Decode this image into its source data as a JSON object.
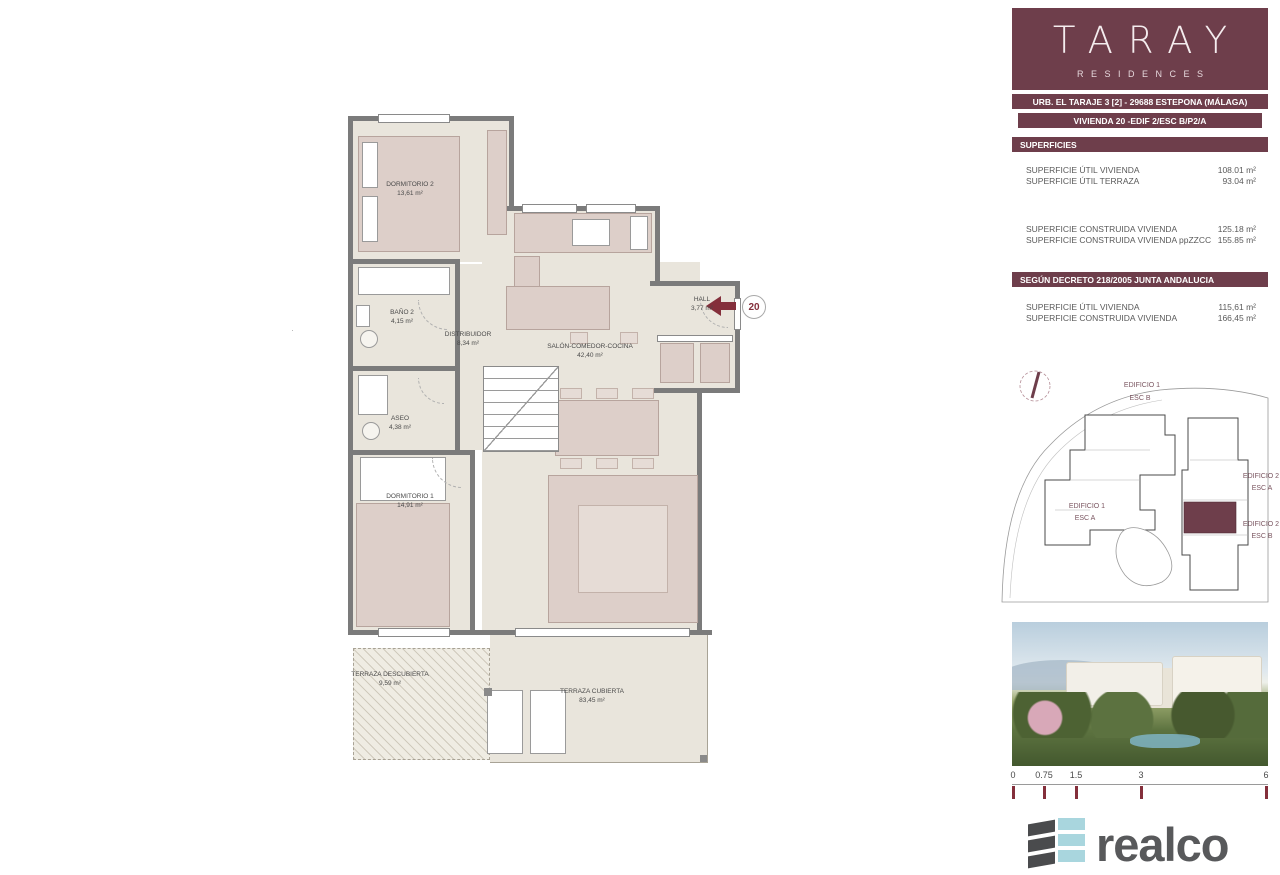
{
  "colors": {
    "brand_maroon": "#6e3e4b",
    "accent_wine": "#842f3b",
    "realco_gray": "#58595b",
    "realco_blue": "#a9d6de"
  },
  "brand": {
    "name": "TARAY",
    "sub": "RESIDENCES"
  },
  "header": {
    "address": "URB. EL TARAJE 3 [2] - 29688 ESTEPONA (MÁLAGA)",
    "unit": "VIVIENDA 20 -EDIF 2/ESC B/P2/A"
  },
  "superficies": {
    "title": "SUPERFICIES",
    "rows_util": [
      {
        "label": "SUPERFICIE ÚTIL VIVIENDA",
        "value": "108.01 m²"
      },
      {
        "label": "SUPERFICIE ÚTIL TERRAZA",
        "value": "93.04 m²"
      }
    ],
    "rows_construida": [
      {
        "label": "SUPERFICIE CONSTRUIDA VIVIENDA",
        "value": "125.18 m²"
      },
      {
        "label": "SUPERFICIE CONSTRUIDA VIVIENDA ppZZCC",
        "value": "155.85 m²"
      }
    ]
  },
  "decreto": {
    "title": "SEGÚN DECRETO 218/2005 JUNTA ANDALUCIA",
    "rows": [
      {
        "label": "SUPERFICIE ÚTIL VIVIENDA",
        "value": "115,61 m²"
      },
      {
        "label": "SUPERFICIE CONSTRUIDA VIVIENDA",
        "value": "166,45 m²"
      }
    ]
  },
  "floorplan": {
    "entry_number": "20",
    "rooms": [
      {
        "name": "DORMITORIO 2",
        "area": "13,61 m²"
      },
      {
        "name": "BAÑO 2",
        "area": "4,15 m²"
      },
      {
        "name": "DISTRIBUIDOR",
        "area": "8,34 m²"
      },
      {
        "name": "ASEO",
        "area": "4,38 m²"
      },
      {
        "name": "DORMITORIO 1",
        "area": "14,91 m²"
      },
      {
        "name": "SALÓN-COMEDOR-COCINA",
        "area": "42,40 m²"
      },
      {
        "name": "HALL",
        "area": "3,77 m²"
      },
      {
        "name": "TERRAZA DESCUBIERTA",
        "area": "9,59 m²"
      },
      {
        "name": "TERRAZA CUBIERTA",
        "area": "83,45 m²"
      }
    ]
  },
  "siteplan": {
    "groups": [
      {
        "building": "EDIFICIO 1",
        "esc": "ESC B"
      },
      {
        "building": "EDIFICIO 1",
        "esc": "ESC A"
      },
      {
        "building": "EDIFICIO 2",
        "esc": "ESC A"
      },
      {
        "building": "EDIFICIO 2",
        "esc": "ESC B"
      }
    ]
  },
  "scalebar": {
    "ticks": [
      "0",
      "0.75",
      "1.5",
      "3",
      "6"
    ]
  },
  "footer": {
    "logo_text": "realco"
  }
}
